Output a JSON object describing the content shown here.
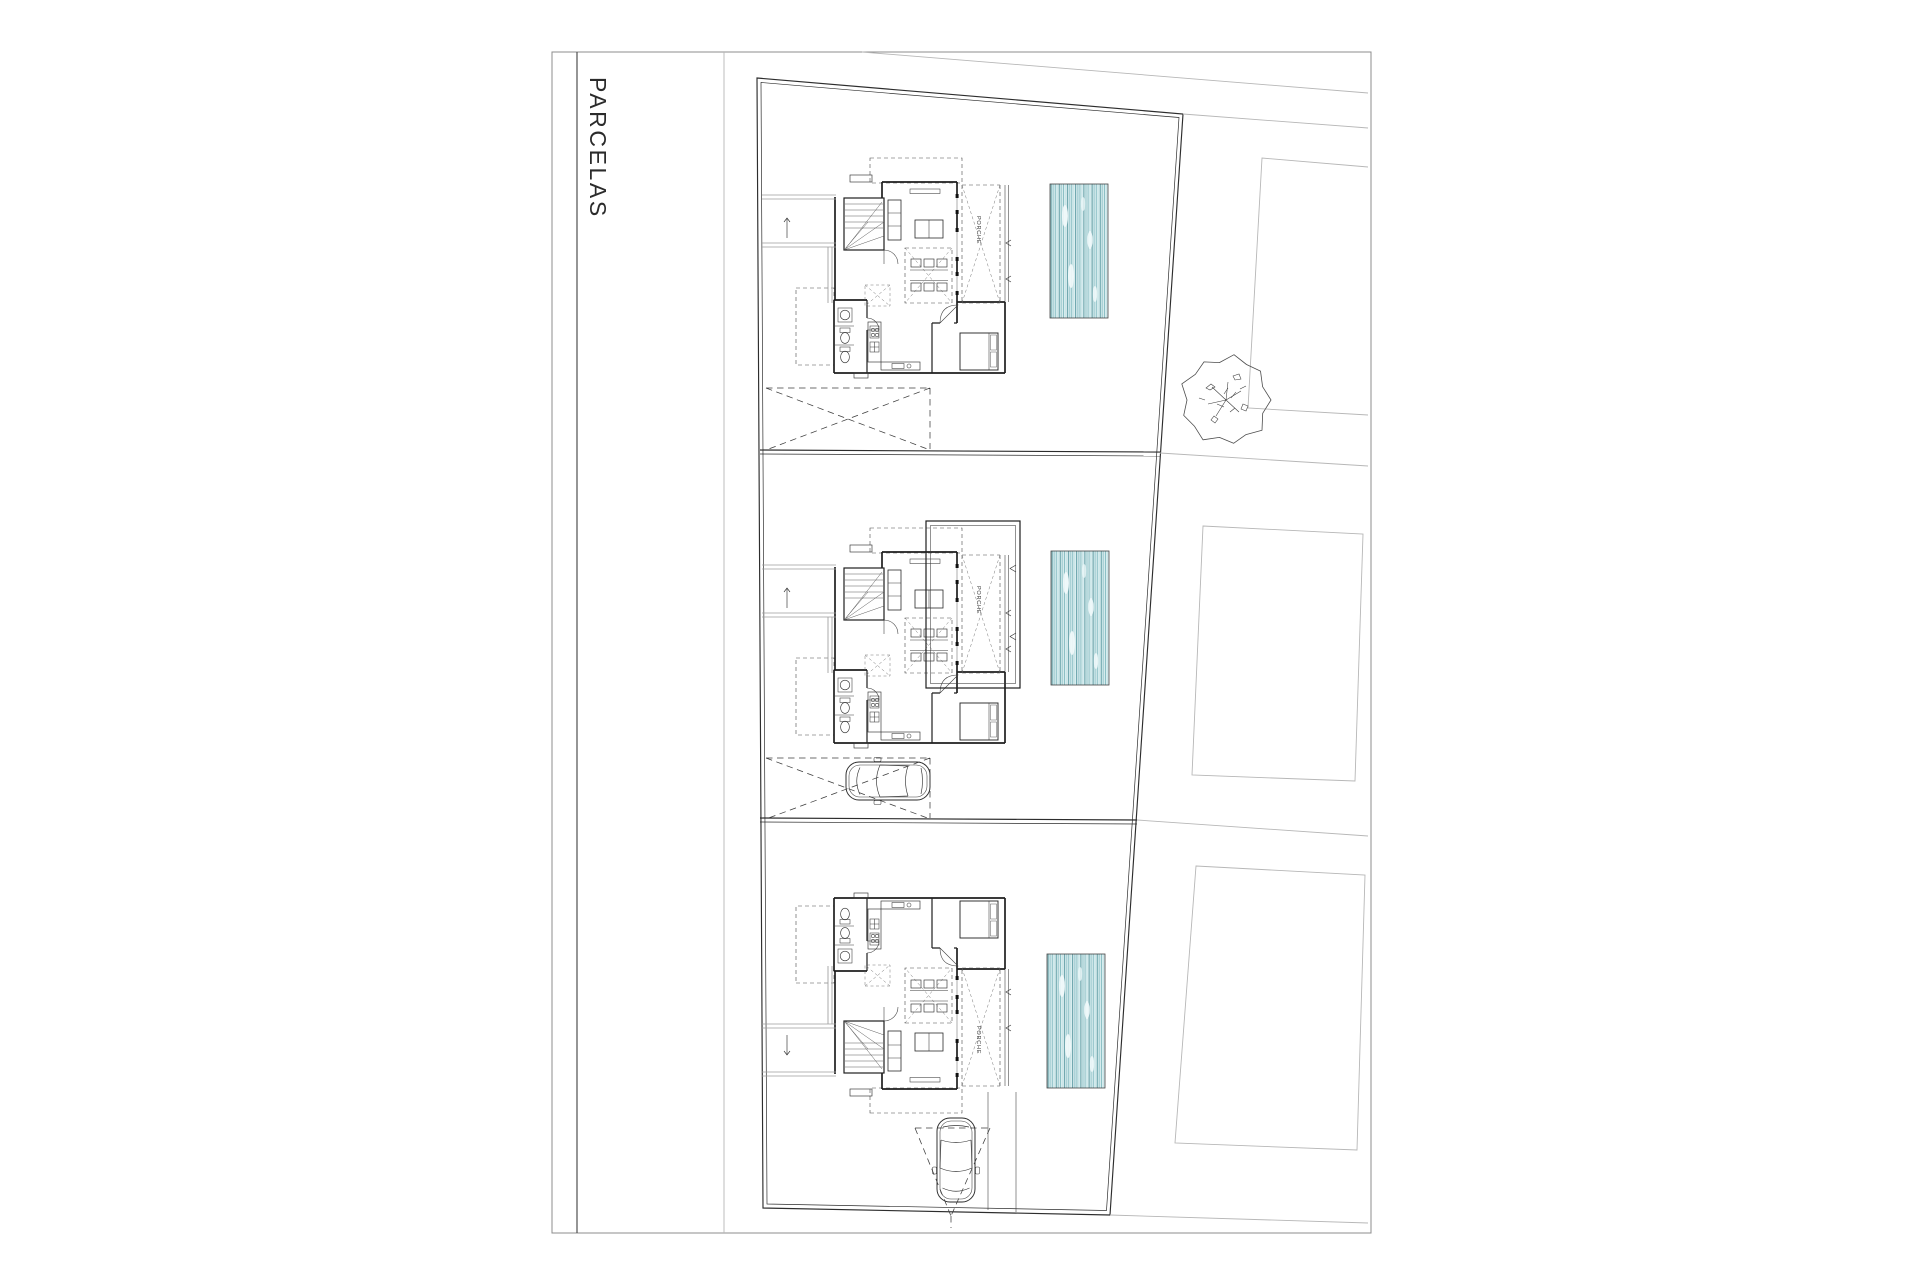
{
  "sheet": {
    "title": "PARCELAS"
  },
  "plan": {
    "porch_label": "PORCHE",
    "parcel_count": 3,
    "house_count": 3,
    "pool_count": 3,
    "car_count": 2,
    "tree_count": 1,
    "colors": {
      "ink": "#2a2a2a",
      "neighbor_lines": "#b7b7b7",
      "pool_water_base": "#ddeef0",
      "pool_stripe_dark": "#4f939b",
      "pool_stripe_mid": "#7fb9bf",
      "pool_stripe_light": "#a9d2d6"
    }
  }
}
